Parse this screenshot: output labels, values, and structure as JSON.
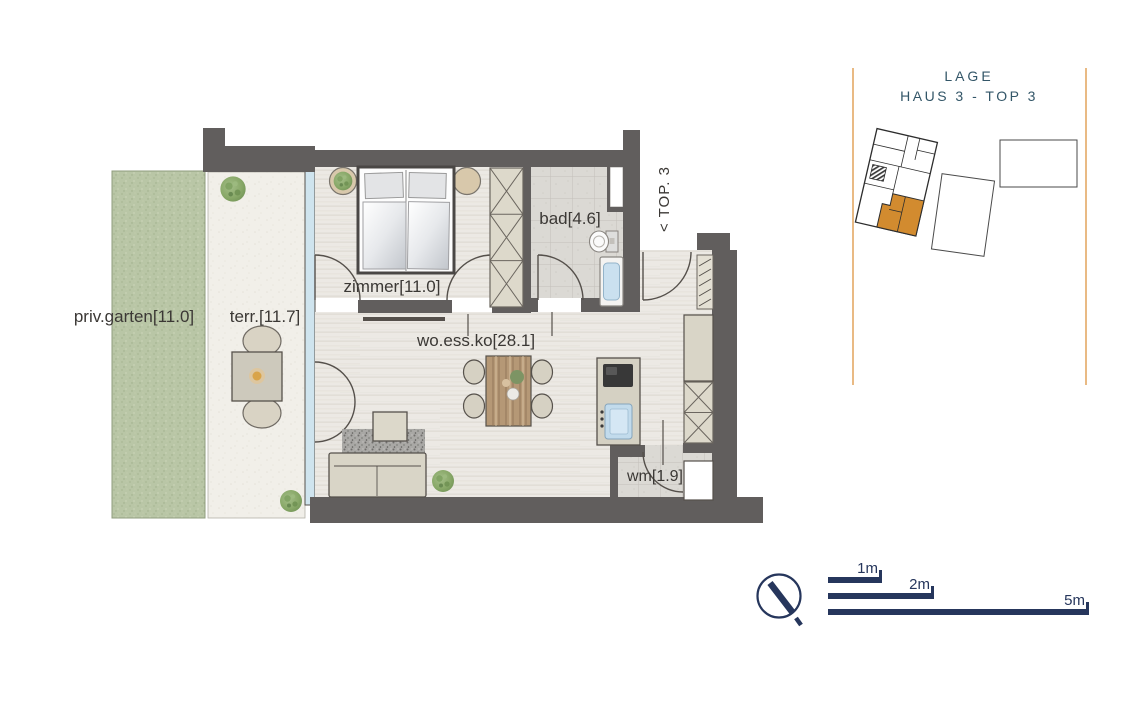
{
  "floorplan": {
    "rooms": {
      "garden": {
        "label": "priv.garten[11.0]"
      },
      "terrace": {
        "label": "terr.[11.7]"
      },
      "bedroom": {
        "label": "zimmer[11.0]"
      },
      "bathroom": {
        "label": "bad[4.6]"
      },
      "living": {
        "label": "wo.ess.ko[28.1]"
      },
      "utility": {
        "label": "wm[1.9]"
      }
    },
    "entry_label": "< TOP. 3"
  },
  "location_panel": {
    "title": "LAGE",
    "subtitle": "HAUS 3 - TOP 3"
  },
  "scale_bar": {
    "bars": [
      {
        "label": "1m",
        "meters": 1
      },
      {
        "label": "2m",
        "meters": 2
      },
      {
        "label": "5m",
        "meters": 5
      }
    ]
  },
  "colors": {
    "wall": "#615e5d",
    "wood_floor": "#ece9e4",
    "tile_floor": "#dbd9d4",
    "garden_green": "#b9c6a6",
    "terrace": "#f1efe9",
    "glass": "#cfe4ee",
    "furniture_beige": "#d7d3c6",
    "accent_orange": "#d28b2f",
    "panel_line_orange": "#e2a35b",
    "navy": "#26365c",
    "panel_text": "#335668",
    "label_text": "#3b3835"
  }
}
